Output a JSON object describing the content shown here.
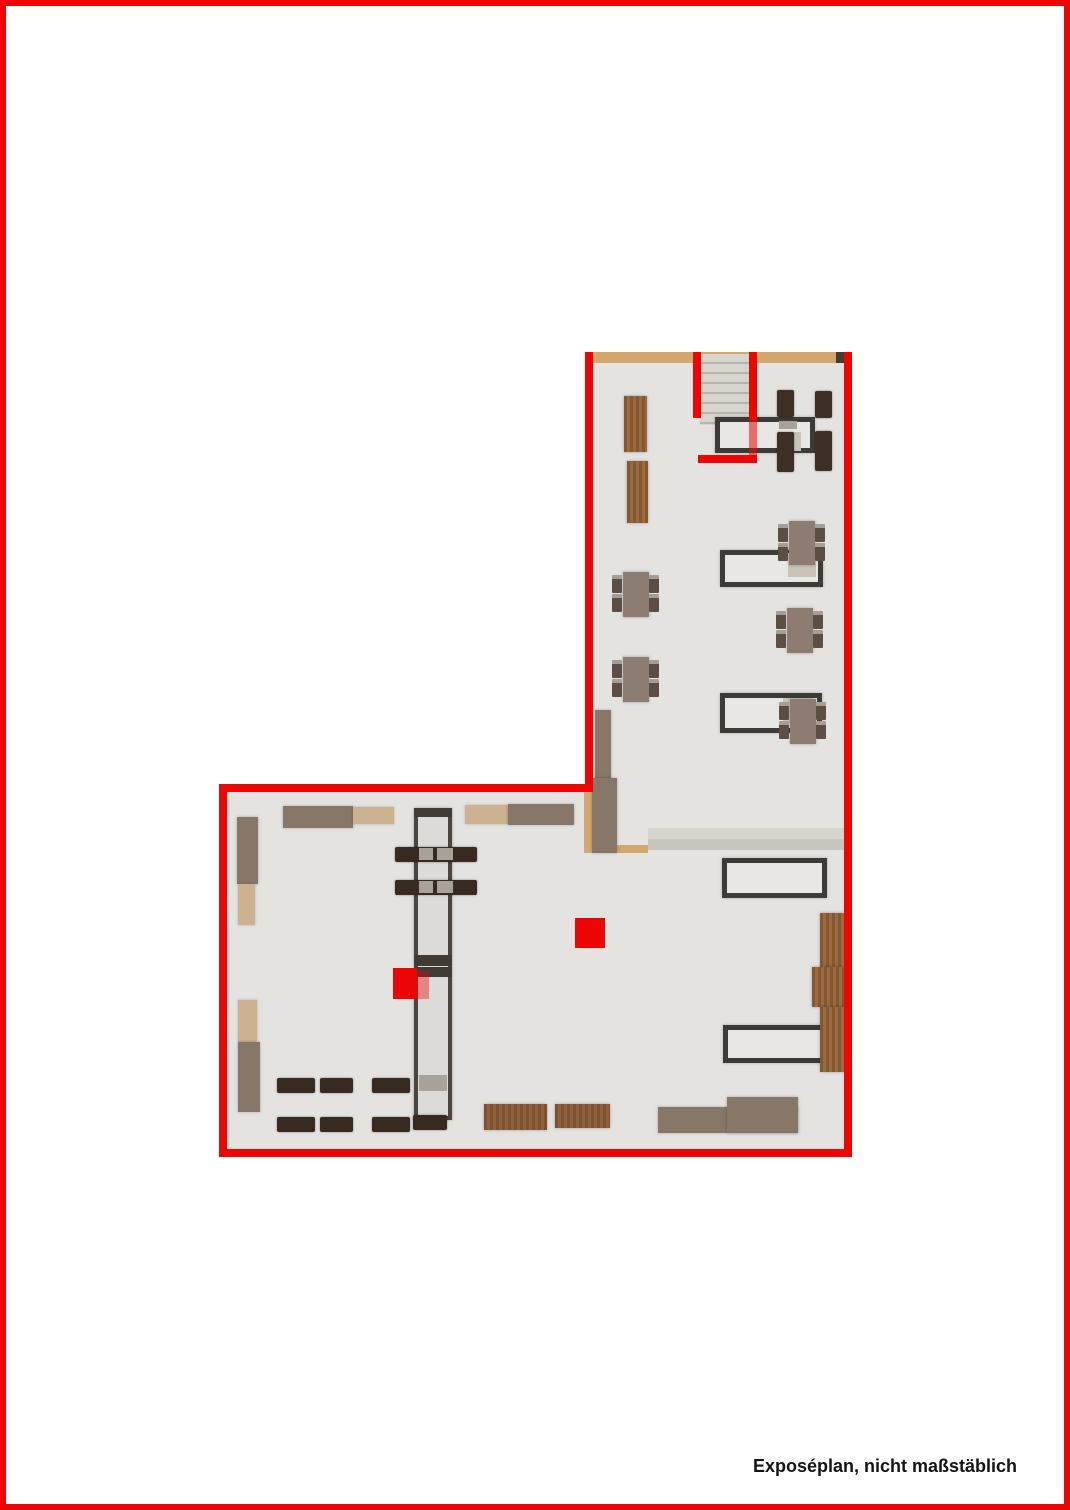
{
  "caption": "Exposéplan, nicht maßstäblich",
  "colors": {
    "red": "#ee0505",
    "floor": "#e4e3e0",
    "woodwall": "#d4a76f",
    "taupe": "#877768",
    "beige": "#ccb290",
    "chairdark": "#3d2f26",
    "deskborder": "#3e3a36",
    "deskbg": "#e8e7e4",
    "counterbg": "#dddbd7"
  },
  "plan": {
    "elements": [
      {
        "name": "floor-upper-wing",
        "kind": "floor",
        "x": 585,
        "y": 352,
        "w": 267,
        "h": 805
      },
      {
        "name": "floor-lower-wing",
        "kind": "floor",
        "x": 219,
        "y": 784,
        "w": 633,
        "h": 373
      },
      {
        "name": "top-wall-wood",
        "kind": "wood-wall",
        "x": 593,
        "y": 352,
        "w": 243,
        "h": 11
      },
      {
        "name": "top-wall-end-cap",
        "kind": "dark-cap",
        "x": 836,
        "y": 352,
        "w": 8,
        "h": 11
      },
      {
        "name": "staircase",
        "kind": "stairs",
        "x": 700,
        "y": 354,
        "w": 49,
        "h": 71
      },
      {
        "name": "hall-strip-upper",
        "kind": "strip-light",
        "x": 648,
        "y": 828,
        "w": 196,
        "h": 11
      },
      {
        "name": "hall-strip-lower",
        "kind": "strip-mid",
        "x": 648,
        "y": 839,
        "w": 196,
        "h": 11
      },
      {
        "name": "junction-wall-wood-vertical",
        "kind": "wood-wall",
        "x": 584,
        "y": 786,
        "w": 10,
        "h": 67
      },
      {
        "name": "junction-wall-wood-horizontal",
        "kind": "wood-wall",
        "x": 584,
        "y": 845,
        "w": 64,
        "h": 8
      },
      {
        "name": "junction-cabinet-narrow",
        "kind": "taupe",
        "x": 595,
        "y": 710,
        "w": 16,
        "h": 68
      },
      {
        "name": "junction-cabinet-wide",
        "kind": "taupe",
        "x": 592,
        "y": 778,
        "w": 25,
        "h": 75
      },
      {
        "name": "wood-shelf-1",
        "kind": "wood-shelf",
        "x": 624,
        "y": 396,
        "w": 23,
        "h": 56
      },
      {
        "name": "wood-shelf-2",
        "kind": "wood-shelf",
        "x": 627,
        "y": 461,
        "w": 21,
        "h": 62
      },
      {
        "name": "entry-table",
        "kind": "desk",
        "x": 715,
        "y": 417,
        "w": 100,
        "h": 36
      },
      {
        "name": "entry-table-seat-1",
        "kind": "seat-light",
        "x": 779,
        "y": 421,
        "w": 18,
        "h": 8
      },
      {
        "name": "entry-table-seat-2",
        "kind": "seat-beige",
        "x": 779,
        "y": 432,
        "w": 22,
        "h": 19
      },
      {
        "name": "entry-chair-1",
        "kind": "chair-dark",
        "x": 777,
        "y": 390,
        "w": 17,
        "h": 27
      },
      {
        "name": "entry-chair-2",
        "kind": "chair-dark",
        "x": 815,
        "y": 391,
        "w": 17,
        "h": 27
      },
      {
        "name": "entry-chair-3",
        "kind": "chair-dark",
        "x": 777,
        "y": 432,
        "w": 17,
        "h": 40
      },
      {
        "name": "entry-chair-4",
        "kind": "chair-dark",
        "x": 815,
        "y": 431,
        "w": 17,
        "h": 40
      },
      {
        "name": "desk-1",
        "kind": "desk",
        "x": 720,
        "y": 550,
        "w": 103,
        "h": 37
      },
      {
        "name": "desk-1-seat",
        "kind": "seat-beige",
        "x": 788,
        "y": 553,
        "w": 28,
        "h": 24
      },
      {
        "name": "desk-2",
        "kind": "desk",
        "x": 720,
        "y": 693,
        "w": 102,
        "h": 40
      },
      {
        "name": "desk-2-seat",
        "kind": "seat-beige",
        "x": 783,
        "y": 698,
        "w": 30,
        "h": 26
      },
      {
        "name": "desk-3",
        "kind": "desk",
        "x": 722,
        "y": 858,
        "w": 105,
        "h": 40
      },
      {
        "name": "desk-4",
        "kind": "desk",
        "x": 723,
        "y": 1025,
        "w": 104,
        "h": 38
      },
      {
        "name": "cafe-table-1",
        "kind": "table-taupe",
        "x": 623,
        "y": 572,
        "w": 26,
        "h": 45
      },
      {
        "name": "cafe-table-1-chair",
        "kind": "chair-small",
        "x": 612,
        "y": 575,
        "w": 10,
        "h": 18
      },
      {
        "name": "cafe-table-1-chair",
        "kind": "chair-small",
        "x": 612,
        "y": 594,
        "w": 10,
        "h": 18
      },
      {
        "name": "cafe-table-1-chair",
        "kind": "chair-small",
        "x": 649,
        "y": 575,
        "w": 10,
        "h": 18
      },
      {
        "name": "cafe-table-1-chair",
        "kind": "chair-small",
        "x": 649,
        "y": 594,
        "w": 10,
        "h": 18
      },
      {
        "name": "cafe-table-2",
        "kind": "table-taupe",
        "x": 623,
        "y": 657,
        "w": 26,
        "h": 45
      },
      {
        "name": "cafe-table-2-chair",
        "kind": "chair-small",
        "x": 612,
        "y": 660,
        "w": 10,
        "h": 18
      },
      {
        "name": "cafe-table-2-chair",
        "kind": "chair-small",
        "x": 612,
        "y": 679,
        "w": 10,
        "h": 18
      },
      {
        "name": "cafe-table-2-chair",
        "kind": "chair-small",
        "x": 649,
        "y": 660,
        "w": 10,
        "h": 18
      },
      {
        "name": "cafe-table-2-chair",
        "kind": "chair-small",
        "x": 649,
        "y": 679,
        "w": 10,
        "h": 18
      },
      {
        "name": "cafe-table-3",
        "kind": "table-taupe",
        "x": 787,
        "y": 608,
        "w": 26,
        "h": 45
      },
      {
        "name": "cafe-table-3-chair",
        "kind": "chair-small",
        "x": 776,
        "y": 611,
        "w": 10,
        "h": 18
      },
      {
        "name": "cafe-table-3-chair",
        "kind": "chair-small",
        "x": 776,
        "y": 630,
        "w": 10,
        "h": 18
      },
      {
        "name": "cafe-table-3-chair",
        "kind": "chair-small",
        "x": 813,
        "y": 611,
        "w": 10,
        "h": 18
      },
      {
        "name": "cafe-table-3-chair",
        "kind": "chair-small",
        "x": 813,
        "y": 630,
        "w": 10,
        "h": 18
      },
      {
        "name": "cafe-table-4",
        "kind": "table-taupe",
        "x": 789,
        "y": 521,
        "w": 26,
        "h": 44
      },
      {
        "name": "cafe-table-4-chair",
        "kind": "chair-small",
        "x": 778,
        "y": 524,
        "w": 10,
        "h": 18
      },
      {
        "name": "cafe-table-4-chair",
        "kind": "chair-small",
        "x": 778,
        "y": 543,
        "w": 10,
        "h": 18
      },
      {
        "name": "cafe-table-4-chair",
        "kind": "chair-small",
        "x": 815,
        "y": 524,
        "w": 10,
        "h": 18
      },
      {
        "name": "cafe-table-4-chair",
        "kind": "chair-small",
        "x": 815,
        "y": 543,
        "w": 10,
        "h": 18
      },
      {
        "name": "cafe-table-5",
        "kind": "table-taupe",
        "x": 790,
        "y": 699,
        "w": 26,
        "h": 45
      },
      {
        "name": "cafe-table-5-chair",
        "kind": "chair-small",
        "x": 779,
        "y": 702,
        "w": 10,
        "h": 18
      },
      {
        "name": "cafe-table-5-chair",
        "kind": "chair-small",
        "x": 779,
        "y": 721,
        "w": 10,
        "h": 18
      },
      {
        "name": "cafe-table-5-chair",
        "kind": "chair-small",
        "x": 816,
        "y": 702,
        "w": 10,
        "h": 18
      },
      {
        "name": "cafe-table-5-chair",
        "kind": "chair-small",
        "x": 816,
        "y": 721,
        "w": 10,
        "h": 18
      },
      {
        "name": "cabinet-left-top",
        "kind": "taupe",
        "x": 237,
        "y": 817,
        "w": 21,
        "h": 67
      },
      {
        "name": "cabinet-left-top-beige",
        "kind": "beige",
        "x": 238,
        "y": 884,
        "w": 17,
        "h": 41
      },
      {
        "name": "cabinet-left-bottom-beige",
        "kind": "beige",
        "x": 238,
        "y": 1000,
        "w": 19,
        "h": 42
      },
      {
        "name": "cabinet-left-bottom",
        "kind": "taupe",
        "x": 238,
        "y": 1042,
        "w": 22,
        "h": 70
      },
      {
        "name": "shelf-top-1-taupe",
        "kind": "taupe",
        "x": 283,
        "y": 806,
        "w": 70,
        "h": 22
      },
      {
        "name": "shelf-top-1-beige",
        "kind": "beige",
        "x": 353,
        "y": 807,
        "w": 41,
        "h": 17
      },
      {
        "name": "shelf-top-2-beige",
        "kind": "beige",
        "x": 465,
        "y": 805,
        "w": 43,
        "h": 19
      },
      {
        "name": "shelf-top-2-taupe",
        "kind": "taupe",
        "x": 508,
        "y": 804,
        "w": 66,
        "h": 21
      },
      {
        "name": "display-counter",
        "kind": "counter",
        "x": 414,
        "y": 808,
        "w": 38,
        "h": 312
      },
      {
        "name": "display-counter-top-cap",
        "kind": "counter-cap",
        "x": 414,
        "y": 808,
        "w": 38,
        "h": 9
      },
      {
        "name": "display-counter-divider-1",
        "kind": "counter-cap",
        "x": 414,
        "y": 955,
        "w": 38,
        "h": 11
      },
      {
        "name": "display-counter-divider-2",
        "kind": "counter-cap",
        "x": 414,
        "y": 967,
        "w": 38,
        "h": 10
      },
      {
        "name": "display-counter-gray-shelf",
        "kind": "seat-light",
        "x": 419,
        "y": 1075,
        "w": 28,
        "h": 16
      },
      {
        "name": "counter-cross-table-1",
        "kind": "bench",
        "x": 395,
        "y": 847,
        "w": 82,
        "h": 15
      },
      {
        "name": "counter-cross-table-1-seat",
        "kind": "seat-light",
        "x": 419,
        "y": 848,
        "w": 14,
        "h": 12
      },
      {
        "name": "counter-cross-table-1-seat",
        "kind": "seat-light",
        "x": 437,
        "y": 848,
        "w": 16,
        "h": 12
      },
      {
        "name": "counter-cross-table-2",
        "kind": "bench",
        "x": 395,
        "y": 880,
        "w": 82,
        "h": 15
      },
      {
        "name": "counter-cross-table-2-seat",
        "kind": "seat-light",
        "x": 419,
        "y": 881,
        "w": 14,
        "h": 12
      },
      {
        "name": "counter-cross-table-2-seat",
        "kind": "seat-light",
        "x": 437,
        "y": 881,
        "w": 16,
        "h": 12
      },
      {
        "name": "bench-row1-1",
        "kind": "bench",
        "x": 277,
        "y": 1078,
        "w": 38,
        "h": 15
      },
      {
        "name": "bench-row1-2",
        "kind": "bench",
        "x": 320,
        "y": 1078,
        "w": 33,
        "h": 15
      },
      {
        "name": "bench-row1-3",
        "kind": "bench",
        "x": 372,
        "y": 1078,
        "w": 38,
        "h": 15
      },
      {
        "name": "bench-row2-1",
        "kind": "bench",
        "x": 277,
        "y": 1117,
        "w": 38,
        "h": 15
      },
      {
        "name": "bench-row2-2",
        "kind": "bench",
        "x": 320,
        "y": 1117,
        "w": 33,
        "h": 15
      },
      {
        "name": "bench-row2-3",
        "kind": "bench",
        "x": 372,
        "y": 1117,
        "w": 38,
        "h": 15
      },
      {
        "name": "bench-row2-4",
        "kind": "bench",
        "x": 413,
        "y": 1115,
        "w": 34,
        "h": 15
      },
      {
        "name": "wood-table-1",
        "kind": "wood-table",
        "x": 484,
        "y": 1104,
        "w": 63,
        "h": 26
      },
      {
        "name": "wood-table-2",
        "kind": "wood-table",
        "x": 555,
        "y": 1104,
        "w": 55,
        "h": 24
      },
      {
        "name": "sideboard-low",
        "kind": "taupe",
        "x": 658,
        "y": 1107,
        "w": 140,
        "h": 26
      },
      {
        "name": "sideboard-high",
        "kind": "taupe",
        "x": 727,
        "y": 1097,
        "w": 71,
        "h": 36
      },
      {
        "name": "wood-rack-right-1",
        "kind": "wood-shelf",
        "x": 820,
        "y": 913,
        "w": 24,
        "h": 59
      },
      {
        "name": "wood-rack-right-2",
        "kind": "wood-shelf",
        "x": 812,
        "y": 967,
        "w": 32,
        "h": 40
      },
      {
        "name": "wood-rack-right-3",
        "kind": "wood-shelf",
        "x": 820,
        "y": 1007,
        "w": 25,
        "h": 65
      },
      {
        "name": "marker-red-large",
        "kind": "marker-red",
        "x": 575,
        "y": 918,
        "w": 30,
        "h": 30
      },
      {
        "name": "marker-red-small",
        "kind": "marker-red",
        "x": 393,
        "y": 968,
        "w": 24,
        "h": 31
      },
      {
        "name": "marker-red-small-overlay",
        "kind": "marker-red-tr",
        "x": 417,
        "y": 971,
        "w": 12,
        "h": 28
      },
      {
        "name": "wall-upper-left",
        "kind": "wall-red",
        "x": 585,
        "y": 352,
        "w": 8,
        "h": 440
      },
      {
        "name": "wall-right",
        "kind": "wall-red",
        "x": 844,
        "y": 352,
        "w": 8,
        "h": 805
      },
      {
        "name": "wall-lower-top",
        "kind": "wall-red",
        "x": 219,
        "y": 784,
        "w": 374,
        "h": 8
      },
      {
        "name": "wall-lower-left",
        "kind": "wall-red",
        "x": 219,
        "y": 784,
        "w": 8,
        "h": 373
      },
      {
        "name": "wall-bottom",
        "kind": "wall-red",
        "x": 219,
        "y": 1149,
        "w": 633,
        "h": 8
      },
      {
        "name": "stair-wall-left",
        "kind": "wall-red",
        "x": 693,
        "y": 352,
        "w": 8,
        "h": 66
      },
      {
        "name": "stair-wall-right",
        "kind": "wall-red",
        "x": 749,
        "y": 352,
        "w": 8,
        "h": 68
      },
      {
        "name": "stair-wall-right-lower",
        "kind": "wall-red-tr",
        "x": 749,
        "y": 420,
        "w": 8,
        "h": 42
      },
      {
        "name": "stair-wall-bottom",
        "kind": "wall-red",
        "x": 698,
        "y": 455,
        "w": 59,
        "h": 8
      }
    ]
  }
}
